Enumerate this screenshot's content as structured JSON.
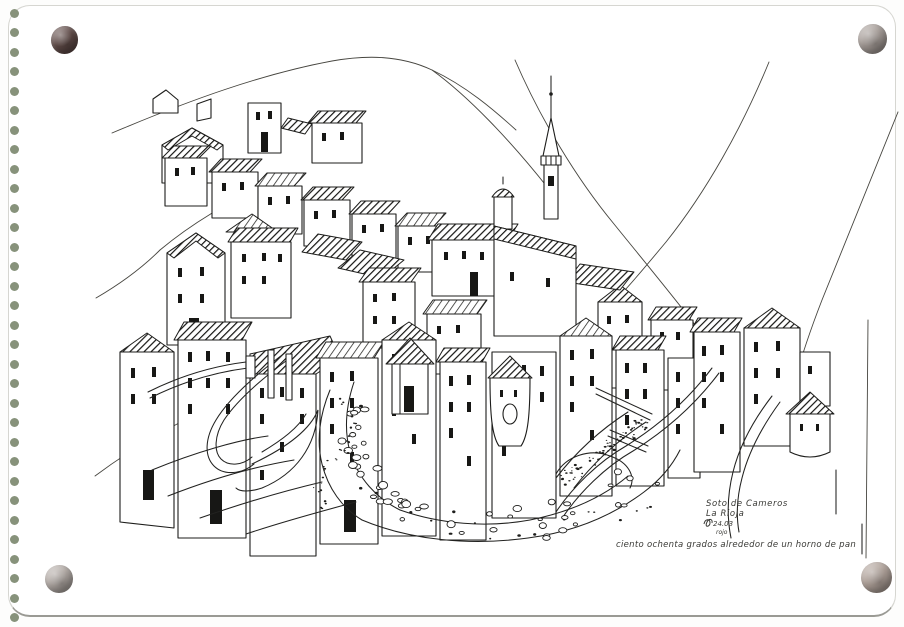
{
  "page": {
    "kind": "scanned sketchbook page",
    "paper_color": "#ffffff",
    "edge_color": "#d6d6d1",
    "binding_holes": {
      "count": 32,
      "color": "#87927b"
    },
    "pebble_magnets": {
      "top_left_color": "#5f4a47",
      "top_right_color": "#a69d98",
      "bottom_left_color": "#b3aba6",
      "bottom_right_color": "#b0a29a"
    }
  },
  "sketch": {
    "ink_color": "#1d1d1b",
    "subject": "Pen-and-ink drawing of a hillside village of tall houses with a church spire above a dry pebbled riverbed",
    "annotations": {
      "place_line1": "Soto de Cameros",
      "place_line2": "La Rioja",
      "signature_date": "24.03",
      "signature_note": "rojo",
      "caption": "ciento ochenta grados alrededor de un horno de pan"
    }
  }
}
